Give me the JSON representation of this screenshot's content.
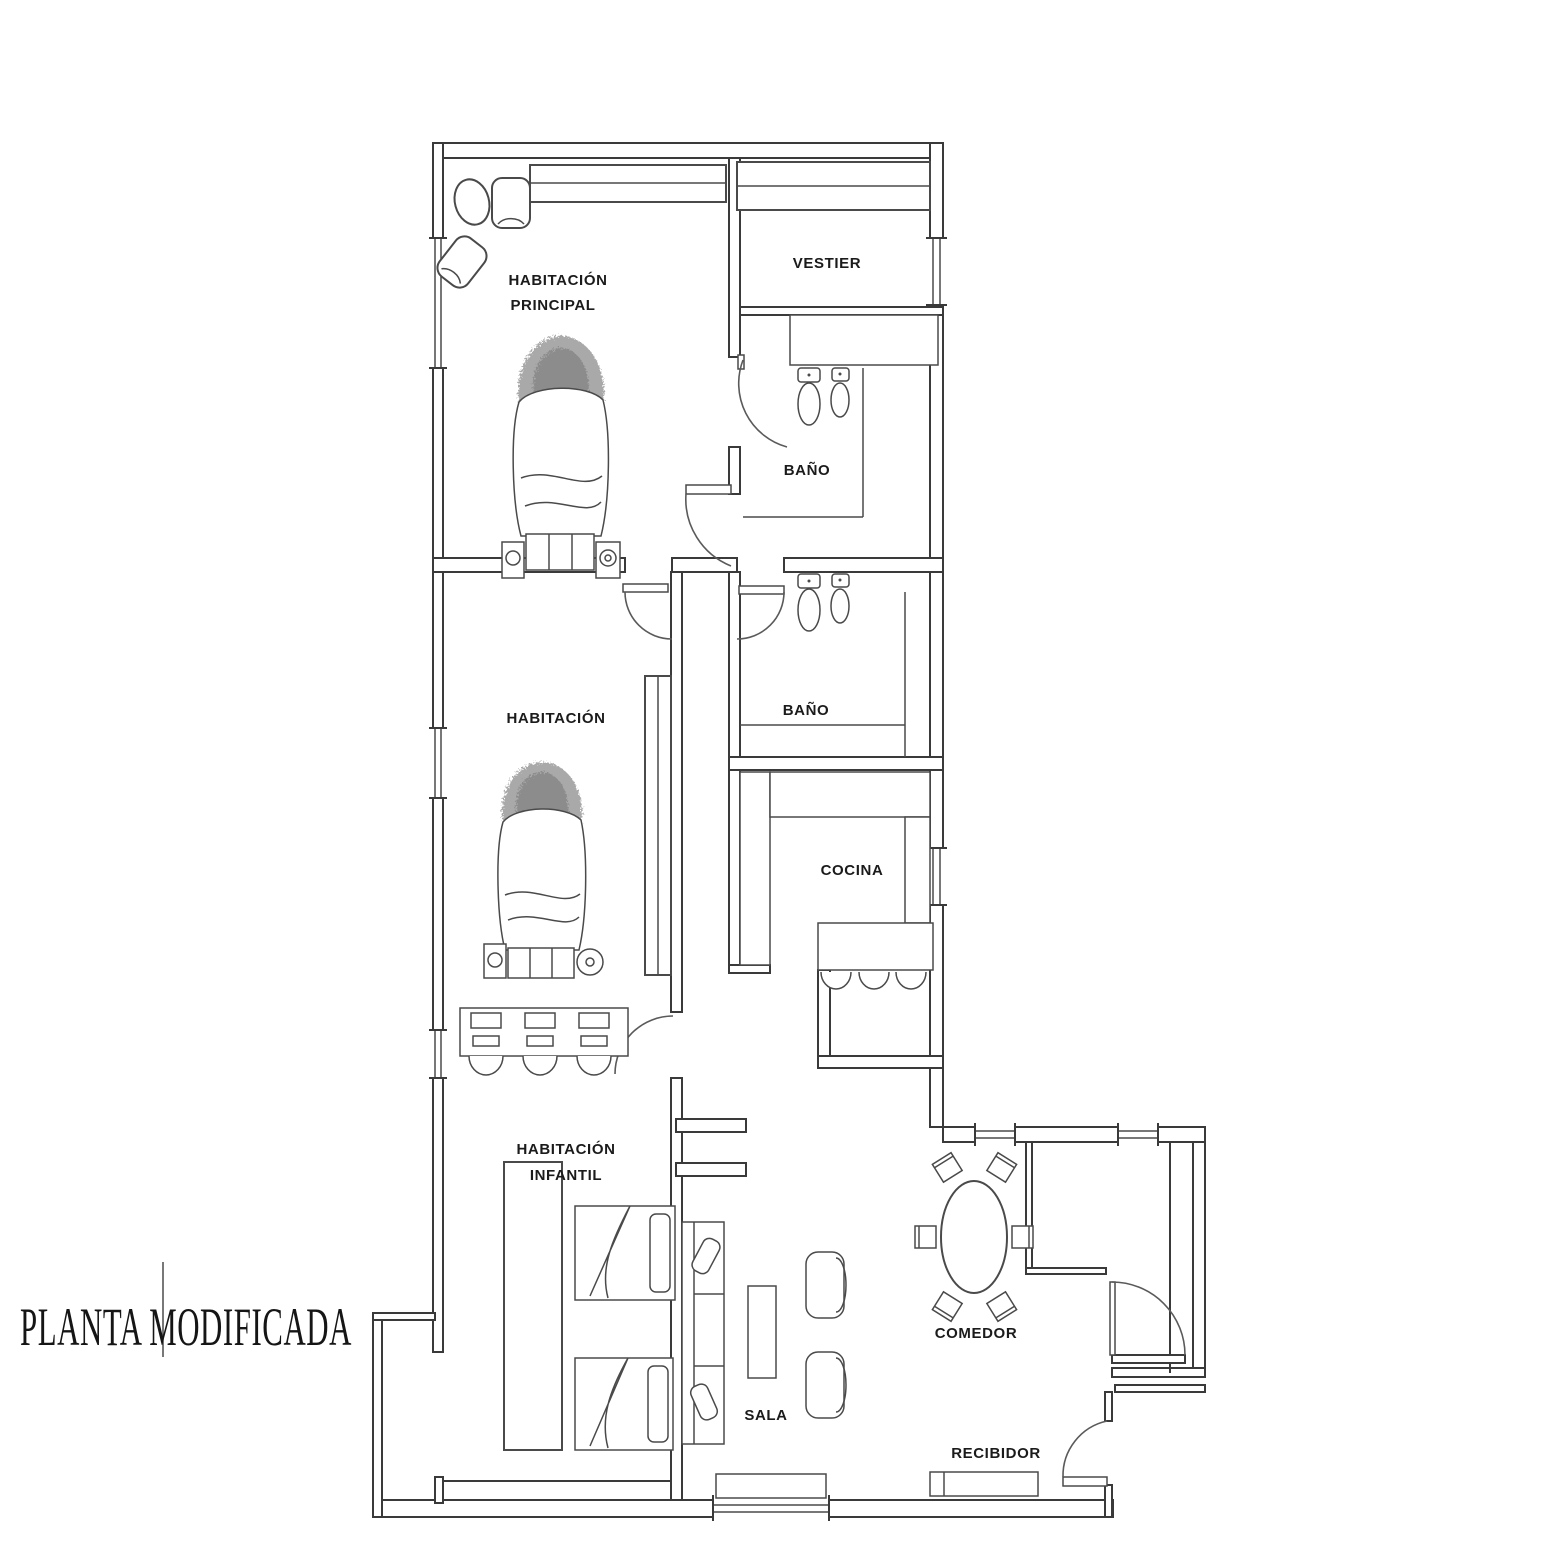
{
  "title": "PLANTA MODIFICADA",
  "rooms": {
    "habitacion_principal": {
      "line1": "HABITACIÓN",
      "line2": "PRINCIPAL"
    },
    "vestier": {
      "label": "VESTIER"
    },
    "bano_1": {
      "label": "BAÑO"
    },
    "habitacion": {
      "label": "HABITACIÓN"
    },
    "bano_2": {
      "label": "BAÑO"
    },
    "cocina": {
      "label": "COCINA"
    },
    "habitacion_infantil": {
      "line1": "HABITACIÓN",
      "line2": "INFANTIL"
    },
    "sala": {
      "label": "SALA"
    },
    "comedor": {
      "label": "COMEDOR"
    },
    "recibidor": {
      "label": "RECIBIDOR"
    }
  }
}
